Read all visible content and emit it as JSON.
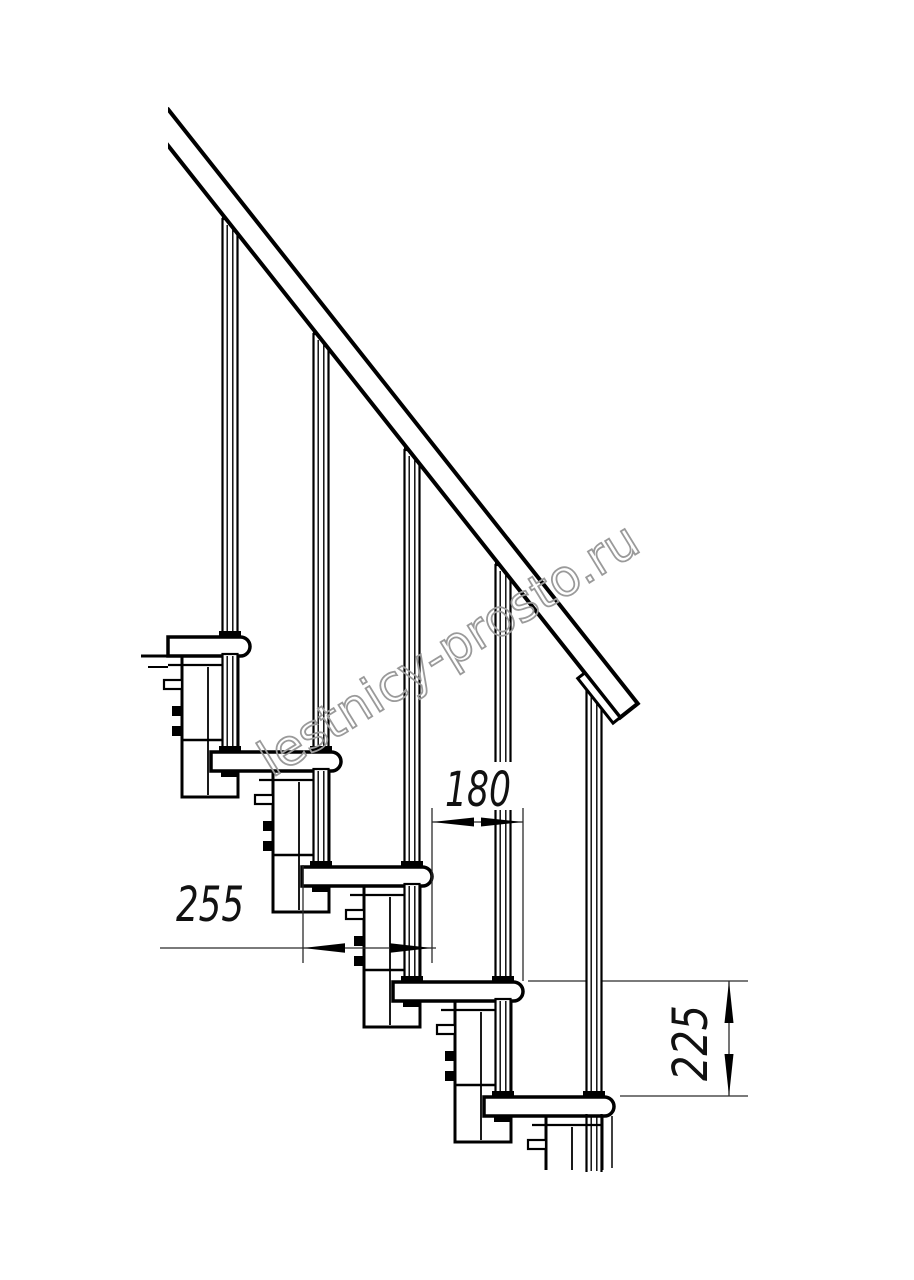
{
  "dimensions": {
    "tread_depth": {
      "value": "255"
    },
    "step_overlap": {
      "value": "180"
    },
    "step_rise": {
      "value": "225"
    }
  },
  "watermark": {
    "text": "lestnicy-prosto.ru",
    "color": "#9a9a9a"
  },
  "colors": {
    "line": "#000000",
    "dimension": "#2b2b2b",
    "background": "#ffffff"
  }
}
